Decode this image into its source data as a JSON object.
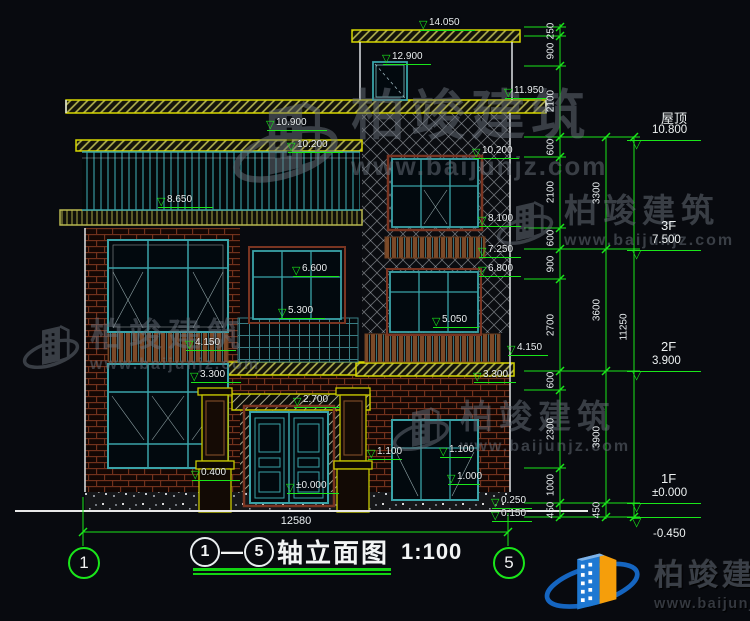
{
  "colors": {
    "background": "#080a0f",
    "dim_green": "#1ae61a",
    "text_white": "#e9eef0",
    "cad_yellow": "#d6d600",
    "window_teal": "#3aa3a8",
    "frame_maroon": "#7a3522",
    "brick_red": "#76331d",
    "brand_blue": "#1565c0",
    "brand_orange": "#f59e0b"
  },
  "watermark": {
    "text": "柏竣建筑",
    "url": "www.baijunjz.com"
  },
  "elevation_markers": [
    {
      "label": "14.050",
      "x": 425,
      "y": 30,
      "w": 55
    },
    {
      "label": "12.900",
      "x": 388,
      "y": 64,
      "w": 48
    },
    {
      "label": "11.950",
      "x": 510,
      "y": 98,
      "w": 42
    },
    {
      "label": "10.900",
      "x": 272,
      "y": 130,
      "w": 60
    },
    {
      "label": "10.200",
      "x": 293,
      "y": 152,
      "w": 55
    },
    {
      "label": "10.200",
      "x": 478,
      "y": 158,
      "w": 46
    },
    {
      "label": "8.650",
      "x": 163,
      "y": 207,
      "w": 55
    },
    {
      "label": "8.100",
      "x": 484,
      "y": 226,
      "w": 42
    },
    {
      "label": "7.250",
      "x": 484,
      "y": 257,
      "w": 42
    },
    {
      "label": "6.800",
      "x": 484,
      "y": 276,
      "w": 42
    },
    {
      "label": "6.600",
      "x": 298,
      "y": 276,
      "w": 46
    },
    {
      "label": "5.300",
      "x": 284,
      "y": 318,
      "w": 46
    },
    {
      "label": "5.050",
      "x": 438,
      "y": 327,
      "w": 46
    },
    {
      "label": "4.150",
      "x": 513,
      "y": 355,
      "w": 40
    },
    {
      "label": "3.300",
      "x": 479,
      "y": 382,
      "w": 42
    },
    {
      "label": "4.150",
      "x": 191,
      "y": 350,
      "w": 50
    },
    {
      "label": "3.300",
      "x": 196,
      "y": 382,
      "w": 50
    },
    {
      "label": "2.700",
      "x": 299,
      "y": 407,
      "w": 46
    },
    {
      "label": "1.100",
      "x": 373,
      "y": 459,
      "w": 34
    },
    {
      "label": "1.100",
      "x": 445,
      "y": 457,
      "w": 32
    },
    {
      "label": "1.000",
      "x": 453,
      "y": 484,
      "w": 32
    },
    {
      "label": "0.400",
      "x": 197,
      "y": 480,
      "w": 48
    },
    {
      "label": "0.250",
      "x": 497,
      "y": 508,
      "w": 40
    },
    {
      "label": "0.150",
      "x": 497,
      "y": 521,
      "w": 40
    },
    {
      "label": "±0.000",
      "x": 292,
      "y": 493,
      "w": 52
    }
  ],
  "floor_markers": [
    {
      "name": "屋顶",
      "value": "10.800",
      "y": 140
    },
    {
      "name": "3F",
      "value": "7.500",
      "y": 250
    },
    {
      "name": "2F",
      "value": "3.900",
      "y": 371
    },
    {
      "name": "1F",
      "value": "±0.000",
      "y": 503
    }
  ],
  "below_datum": {
    "label": "-0.450"
  },
  "chain_values": [
    {
      "v": "250",
      "x": 551,
      "y": 31
    },
    {
      "v": "900",
      "x": 551,
      "y": 51
    },
    {
      "v": "2100",
      "x": 551,
      "y": 101
    },
    {
      "v": "600",
      "x": 551,
      "y": 147
    },
    {
      "v": "2100",
      "x": 551,
      "y": 192
    },
    {
      "v": "600",
      "x": 551,
      "y": 238
    },
    {
      "v": "900",
      "x": 551,
      "y": 264
    },
    {
      "v": "2700",
      "x": 551,
      "y": 325
    },
    {
      "v": "600",
      "x": 551,
      "y": 380
    },
    {
      "v": "2300",
      "x": 551,
      "y": 429
    },
    {
      "v": "1000",
      "x": 551,
      "y": 485
    },
    {
      "v": "450",
      "x": 551,
      "y": 510
    },
    {
      "v": "3300",
      "x": 597,
      "y": 193
    },
    {
      "v": "3600",
      "x": 597,
      "y": 310
    },
    {
      "v": "3900",
      "x": 597,
      "y": 437
    },
    {
      "v": "450",
      "x": 597,
      "y": 510
    },
    {
      "v": "11250",
      "x": 624,
      "y": 327
    }
  ],
  "axes": [
    {
      "n": "1",
      "x": 68
    },
    {
      "n": "5",
      "x": 493
    }
  ],
  "bottom": {
    "total_width": "12580"
  },
  "title": {
    "axis_from": "1",
    "dash": "—",
    "axis_to": "5",
    "text": "轴立面图",
    "scale": "1:100"
  },
  "brand": {
    "name": "柏竣建筑",
    "url": "www.baijunjz.com"
  }
}
